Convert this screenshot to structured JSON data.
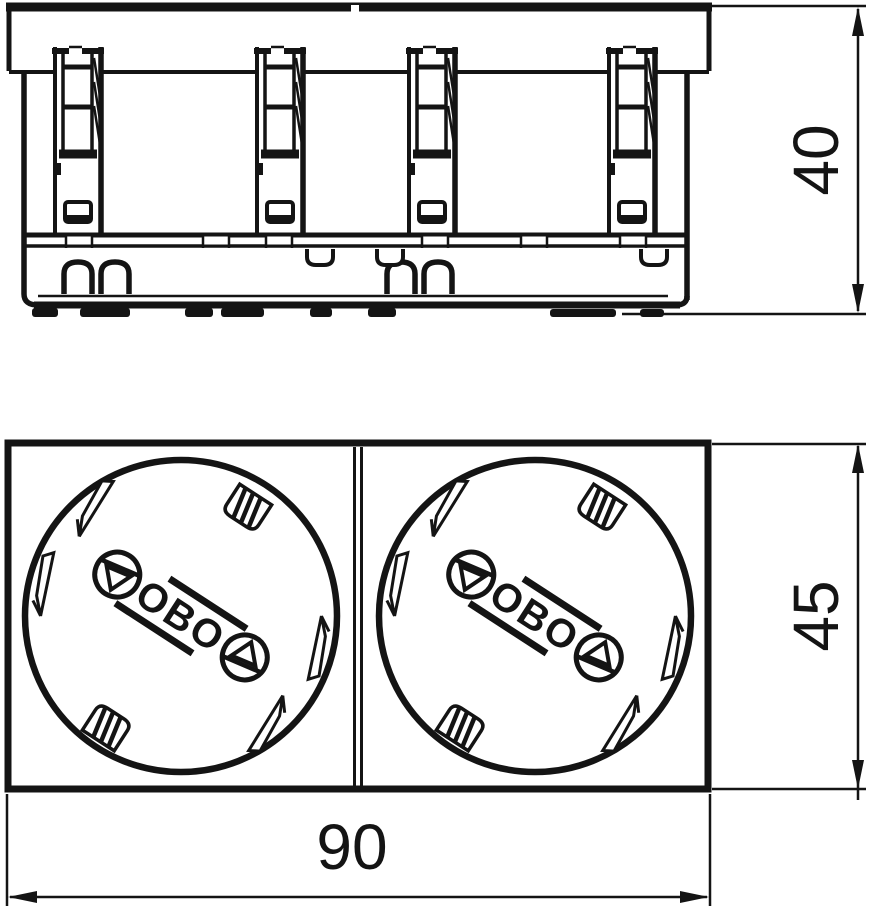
{
  "colors": {
    "background": "#ffffff",
    "line": "#141414"
  },
  "side_view": {
    "dim_height": "40"
  },
  "front_view": {
    "dim_height": "45",
    "dim_width": "90",
    "sockets": [
      {
        "logo": "OBO"
      },
      {
        "logo": "OBO"
      }
    ]
  }
}
